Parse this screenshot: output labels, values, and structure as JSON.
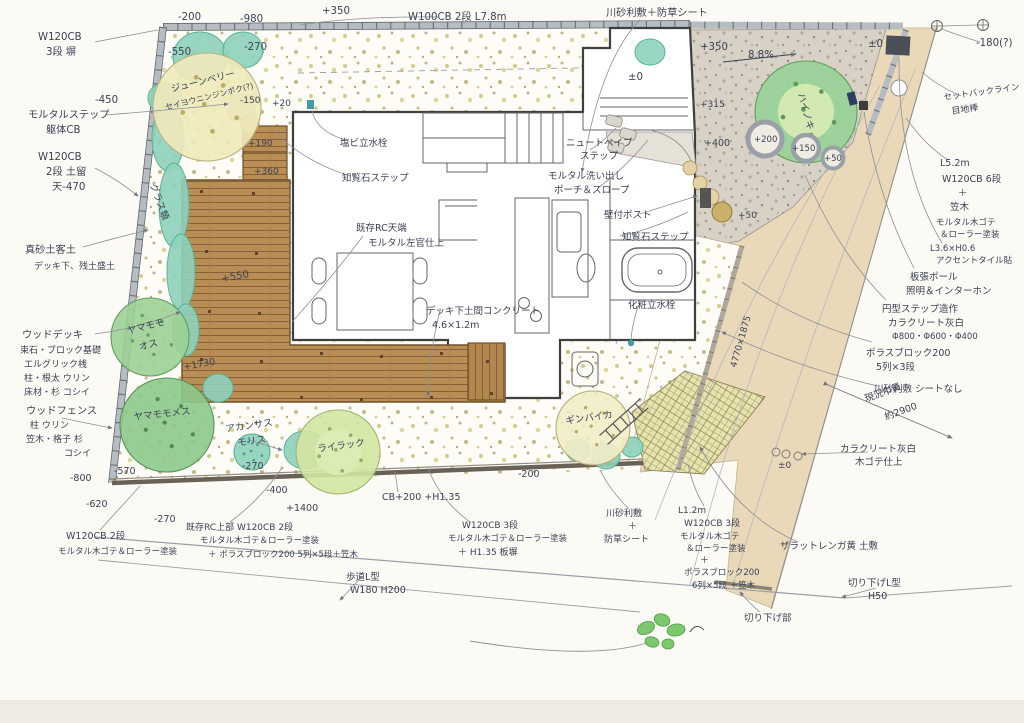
{
  "plan": {
    "ink_color": "#3c4257",
    "paper_color": "#fbfaf4",
    "deck_color": "#b98e54",
    "concrete_color": "#d8d1c5",
    "approach_color": "#ead9b9",
    "teal_plant_color": "#8ed2bc",
    "brick_area_color": "#e7e3ae"
  },
  "plants": [
    {
      "name": "june-berry",
      "label": "ジューンベリー セイヨウニンジンボク(?)",
      "cx": 207,
      "cy": 107,
      "r": 54,
      "fill": "#efe9ba",
      "stroke": "#b9b183",
      "dot": "#bcae62"
    },
    {
      "name": "yamamomo-male",
      "label": "ヤマモモ オス",
      "cx": 150,
      "cy": 337,
      "r": 39,
      "fill": "#9cd096",
      "stroke": "#5f9e5f",
      "dot": "#63a463"
    },
    {
      "name": "yamamomo-female",
      "label": "ヤマモモ メス",
      "cx": 167,
      "cy": 425,
      "r": 47,
      "fill": "#8cc98b",
      "stroke": "#569355",
      "dot": "#4f8c4f"
    },
    {
      "name": "lilac",
      "label": "ライラック",
      "cx": 338,
      "cy": 452,
      "r": 42,
      "fill": "#d3e5a3",
      "stroke": "#9ab86e",
      "dot": "#95b164"
    },
    {
      "name": "ginbaika",
      "label": "ギンバイカ",
      "cx": 593,
      "cy": 428,
      "r": 37,
      "fill": "#f2ecc7",
      "stroke": "#b8ad74",
      "dot": "#b5a963"
    },
    {
      "name": "hainoki",
      "label": "ハイノキ",
      "cx": 806,
      "cy": 112,
      "r": 51,
      "fill": "#98d198",
      "stroke": "#5f9e5f",
      "dot": "#5a9b5a"
    },
    {
      "name": "acanthus-mollis",
      "label": "アカンサスモリス",
      "cx": 252,
      "cy": 452,
      "r": 18,
      "fill": "#8ed2bc",
      "stroke": "#58b394",
      "dot": "#4da183"
    }
  ],
  "shrubs": [
    {
      "cx": 200,
      "cy": 57,
      "rx": 27,
      "ry": 25
    },
    {
      "cx": 243,
      "cy": 50,
      "rx": 20,
      "ry": 18
    },
    {
      "cx": 165,
      "cy": 98,
      "rx": 17,
      "ry": 15
    },
    {
      "cx": 168,
      "cy": 138,
      "rx": 16,
      "ry": 33
    },
    {
      "cx": 174,
      "cy": 205,
      "rx": 15,
      "ry": 42
    },
    {
      "cx": 181,
      "cy": 272,
      "rx": 14,
      "ry": 38
    },
    {
      "cx": 186,
      "cy": 330,
      "rx": 13,
      "ry": 26
    },
    {
      "cx": 218,
      "cy": 388,
      "rx": 15,
      "ry": 14
    },
    {
      "cx": 305,
      "cy": 450,
      "rx": 21,
      "ry": 19
    },
    {
      "cx": 578,
      "cy": 450,
      "rx": 12,
      "ry": 11
    },
    {
      "cx": 606,
      "cy": 456,
      "rx": 14,
      "ry": 13
    },
    {
      "cx": 632,
      "cy": 447,
      "rx": 11,
      "ry": 10
    },
    {
      "cx": 650,
      "cy": 52,
      "rx": 15,
      "ry": 13
    }
  ],
  "annotations": [
    {
      "t": "W120CB",
      "x": 38,
      "y": 40
    },
    {
      "t": "3段 塀",
      "x": 46,
      "y": 55
    },
    {
      "t": "-200",
      "x": 178,
      "y": 20
    },
    {
      "t": "-980",
      "x": 240,
      "y": 22
    },
    {
      "t": "+350",
      "x": 322,
      "y": 14
    },
    {
      "t": "W100CB 2段 L7.8m",
      "x": 408,
      "y": 20
    },
    {
      "t": "川砂利敷＋防草シート",
      "x": 606,
      "y": 16
    },
    {
      "t": "-180(?)",
      "x": 976,
      "y": 46
    },
    {
      "t": "-550",
      "x": 168,
      "y": 55
    },
    {
      "t": "-270",
      "x": 244,
      "y": 50
    },
    {
      "t": "±0",
      "x": 628,
      "y": 80
    },
    {
      "t": "±0",
      "x": 868,
      "y": 47
    },
    {
      "t": "+350",
      "x": 700,
      "y": 50
    },
    {
      "t": "8.8%",
      "x": 748,
      "y": 58
    },
    {
      "t": "-450",
      "x": 95,
      "y": 103
    },
    {
      "t": "モルタルステップ",
      "x": 28,
      "y": 118
    },
    {
      "t": "躯体CB",
      "x": 46,
      "y": 133
    },
    {
      "t": "-150",
      "x": 240,
      "y": 103,
      "s": 9
    },
    {
      "t": "+20",
      "x": 272,
      "y": 106,
      "s": 9
    },
    {
      "t": "W120CB",
      "x": 38,
      "y": 160
    },
    {
      "t": "2段 土留",
      "x": 46,
      "y": 175
    },
    {
      "t": "天-470",
      "x": 52,
      "y": 190
    },
    {
      "t": "ジューンベリー",
      "x": 172,
      "y": 92,
      "r": -14,
      "s": 9.5
    },
    {
      "t": "セイヨウニンジンボク(?)",
      "x": 166,
      "y": 110,
      "r": -14,
      "s": 8
    },
    {
      "t": "グラス類",
      "x": 150,
      "y": 185,
      "r": 70,
      "s": 9.5
    },
    {
      "t": "+190",
      "x": 248,
      "y": 146,
      "s": 9
    },
    {
      "t": "+360",
      "x": 254,
      "y": 174,
      "s": 9
    },
    {
      "t": "真砂土客土",
      "x": 25,
      "y": 253
    },
    {
      "t": "デッキ下、残土盛土",
      "x": 34,
      "y": 269,
      "s": 9
    },
    {
      "t": "塩ビ立水栓",
      "x": 340,
      "y": 146,
      "s": 9.5
    },
    {
      "t": "知覧石ステップ",
      "x": 342,
      "y": 181,
      "s": 9.5
    },
    {
      "t": "既存RC天端",
      "x": 356,
      "y": 231,
      "s": 9.5
    },
    {
      "t": "モルタル左官仕上",
      "x": 368,
      "y": 246,
      "s": 9.5
    },
    {
      "t": "+550",
      "x": 222,
      "y": 282,
      "r": -10
    },
    {
      "t": "+1730",
      "x": 184,
      "y": 370,
      "r": -10,
      "s": 9.5
    },
    {
      "t": "ヤマモモ",
      "x": 128,
      "y": 334,
      "r": -14,
      "s": 9.5
    },
    {
      "t": "オス",
      "x": 140,
      "y": 350,
      "r": -14,
      "s": 9.5
    },
    {
      "t": "ヤマモモメス",
      "x": 134,
      "y": 420,
      "r": -6,
      "s": 9.5
    },
    {
      "t": "ウッドデッキ",
      "x": 22,
      "y": 338
    },
    {
      "t": "束石・ブロック基礎",
      "x": 20,
      "y": 353,
      "s": 9
    },
    {
      "t": "エルグリック桟",
      "x": 24,
      "y": 367,
      "s": 9
    },
    {
      "t": "柱・根太 ウリン",
      "x": 24,
      "y": 381,
      "s": 9
    },
    {
      "t": "床材・杉 コシイ",
      "x": 24,
      "y": 395,
      "s": 9
    },
    {
      "t": "ウッドフェンス",
      "x": 26,
      "y": 414
    },
    {
      "t": "柱 ウリン",
      "x": 30,
      "y": 428,
      "s": 9
    },
    {
      "t": "笠木・格子 杉",
      "x": 26,
      "y": 442,
      "s": 9
    },
    {
      "t": "コシイ",
      "x": 64,
      "y": 456,
      "s": 9
    },
    {
      "t": "アカンサス",
      "x": 226,
      "y": 432,
      "r": -8,
      "s": 9.5
    },
    {
      "t": "モリス",
      "x": 238,
      "y": 446,
      "r": -8,
      "s": 9.5
    },
    {
      "t": "ライラック",
      "x": 318,
      "y": 452,
      "r": -8,
      "s": 9.5
    },
    {
      "t": "ギンバイカ",
      "x": 566,
      "y": 424,
      "r": -8,
      "s": 9.5
    },
    {
      "t": "ハイノキ",
      "x": 798,
      "y": 94,
      "r": 75,
      "s": 9.5
    },
    {
      "t": "+50",
      "x": 738,
      "y": 218,
      "s": 9
    },
    {
      "t": "+315",
      "x": 700,
      "y": 107,
      "s": 9
    },
    {
      "t": "+400",
      "x": 704,
      "y": 146,
      "s": 9.5
    },
    {
      "t": "+200",
      "x": 754,
      "y": 142,
      "s": 8.5
    },
    {
      "t": "+150",
      "x": 792,
      "y": 151,
      "s": 8.5
    },
    {
      "t": "+50",
      "x": 824,
      "y": 161,
      "s": 8.5
    },
    {
      "t": "±0",
      "x": 778,
      "y": 468,
      "s": 9
    },
    {
      "t": "4770×1875",
      "x": 736,
      "y": 368,
      "r": -74,
      "s": 9
    },
    {
      "t": "ニュートペイブ",
      "x": 566,
      "y": 146,
      "s": 9.5
    },
    {
      "t": "ステップ",
      "x": 580,
      "y": 159,
      "s": 9.5
    },
    {
      "t": "モルタル洗い出し",
      "x": 548,
      "y": 179,
      "s": 9.5
    },
    {
      "t": "ポーチ＆スロープ",
      "x": 554,
      "y": 193,
      "s": 9.5
    },
    {
      "t": "壁付ポスト",
      "x": 604,
      "y": 218,
      "s": 9.5
    },
    {
      "t": "知覧石ステップ",
      "x": 622,
      "y": 240,
      "s": 9.5
    },
    {
      "t": "化粧立水栓",
      "x": 628,
      "y": 308,
      "s": 9.5
    },
    {
      "t": "デッキ下土間コンクリート",
      "x": 426,
      "y": 314,
      "s": 9.5
    },
    {
      "t": "4.6×1.2m",
      "x": 432,
      "y": 328,
      "s": 9.5
    },
    {
      "t": "-800",
      "x": 70,
      "y": 481,
      "s": 9.5
    },
    {
      "t": "-620",
      "x": 86,
      "y": 507,
      "s": 9.5
    },
    {
      "t": "-570",
      "x": 114,
      "y": 474,
      "s": 9.5
    },
    {
      "t": "-270",
      "x": 242,
      "y": 469,
      "s": 9.5
    },
    {
      "t": "-270",
      "x": 154,
      "y": 522,
      "s": 9.5
    },
    {
      "t": "-400",
      "x": 266,
      "y": 493,
      "s": 9.5
    },
    {
      "t": "+1400",
      "x": 286,
      "y": 511,
      "s": 9.5
    },
    {
      "t": "-200",
      "x": 518,
      "y": 477,
      "s": 9.5
    },
    {
      "t": "W120CB 2段",
      "x": 66,
      "y": 539,
      "s": 9.5
    },
    {
      "t": "モルタル木ゴテ＆ローラー塗装",
      "x": 58,
      "y": 554,
      "s": 8.5
    },
    {
      "t": "既存RC上部 W120CB 2段",
      "x": 186,
      "y": 530,
      "s": 9
    },
    {
      "t": "モルタル木ゴテ＆ローラー塗装",
      "x": 200,
      "y": 543,
      "s": 8.5
    },
    {
      "t": "＋ ポラスブロック200 5列×5段＋笠木",
      "x": 208,
      "y": 557,
      "s": 8.5
    },
    {
      "t": "CB+200 +H1.35",
      "x": 382,
      "y": 500,
      "s": 9.5
    },
    {
      "t": "W120CB 3段",
      "x": 462,
      "y": 528,
      "s": 9
    },
    {
      "t": "モルタル木ゴテ＆ローラー塗装",
      "x": 448,
      "y": 541,
      "s": 8.5
    },
    {
      "t": "＋ H1.35 板塀",
      "x": 458,
      "y": 555,
      "s": 9
    },
    {
      "t": "川砂利敷",
      "x": 606,
      "y": 516,
      "s": 9
    },
    {
      "t": "＋",
      "x": 628,
      "y": 529,
      "s": 9
    },
    {
      "t": "防草シート",
      "x": 604,
      "y": 542,
      "s": 9
    },
    {
      "t": "L1.2m",
      "x": 678,
      "y": 513,
      "s": 9
    },
    {
      "t": "W120CB 3段",
      "x": 684,
      "y": 526,
      "s": 9
    },
    {
      "t": "モルタル木ゴテ",
      "x": 680,
      "y": 539,
      "s": 8.5
    },
    {
      "t": "＆ローラー塗装",
      "x": 686,
      "y": 551,
      "s": 8.5
    },
    {
      "t": "＋",
      "x": 700,
      "y": 563,
      "s": 9
    },
    {
      "t": "ポラスブロック200",
      "x": 684,
      "y": 575,
      "s": 8.5
    },
    {
      "t": "6列×5段 ＋笠木",
      "x": 692,
      "y": 588,
      "s": 8.5
    },
    {
      "t": "ザラットレンガ黄 土敷",
      "x": 780,
      "y": 549,
      "s": 9.5
    },
    {
      "t": "切り下げL型",
      "x": 848,
      "y": 586,
      "s": 9.5
    },
    {
      "t": "H50",
      "x": 868,
      "y": 599,
      "s": 9.5
    },
    {
      "t": "切り下げ部",
      "x": 744,
      "y": 621,
      "s": 9.5
    },
    {
      "t": "歩道L型",
      "x": 346,
      "y": 580,
      "s": 9.5
    },
    {
      "t": "W180 H200",
      "x": 350,
      "y": 593,
      "s": 9.5
    },
    {
      "t": "現況巾員",
      "x": 866,
      "y": 402,
      "r": -20,
      "s": 9.5
    },
    {
      "t": "約2900",
      "x": 886,
      "y": 420,
      "r": -20,
      "s": 9.5
    },
    {
      "t": "セットバックライン",
      "x": 944,
      "y": 100,
      "r": -8,
      "s": 8.5
    },
    {
      "t": "目地棒",
      "x": 952,
      "y": 114,
      "r": -8,
      "s": 9
    },
    {
      "t": "L5.2m",
      "x": 940,
      "y": 166,
      "s": 9.5
    },
    {
      "t": "W120CB 6段",
      "x": 942,
      "y": 182,
      "s": 9.5
    },
    {
      "t": "＋",
      "x": 958,
      "y": 196,
      "s": 9.5
    },
    {
      "t": "笠木",
      "x": 950,
      "y": 210,
      "s": 9.5
    },
    {
      "t": "モルタル木ゴテ",
      "x": 936,
      "y": 225,
      "s": 8.5
    },
    {
      "t": "＆ローラー塗装",
      "x": 940,
      "y": 237,
      "s": 8.5
    },
    {
      "t": "L3.6×H0.6",
      "x": 930,
      "y": 251,
      "s": 8.5
    },
    {
      "t": "アクセントタイル貼",
      "x": 936,
      "y": 263,
      "s": 8.5
    },
    {
      "t": "板張ポール",
      "x": 910,
      "y": 280,
      "s": 9.5
    },
    {
      "t": "照明＆インターホン",
      "x": 906,
      "y": 294,
      "s": 9.5
    },
    {
      "t": "円型ステップ造作",
      "x": 882,
      "y": 312,
      "s": 9.5
    },
    {
      "t": "カラクリート灰白",
      "x": 888,
      "y": 326,
      "s": 9.5
    },
    {
      "t": "Φ800・Φ600・Φ400",
      "x": 892,
      "y": 339,
      "s": 8.5
    },
    {
      "t": "ポラスブロック200",
      "x": 866,
      "y": 356,
      "s": 9.5
    },
    {
      "t": "5列×3段",
      "x": 876,
      "y": 370,
      "s": 9.5
    },
    {
      "t": "川砂利敷 シートなし",
      "x": 874,
      "y": 392,
      "s": 9.5
    },
    {
      "t": "カラクリート灰白",
      "x": 840,
      "y": 452,
      "s": 9.5
    },
    {
      "t": "木ゴテ仕上",
      "x": 855,
      "y": 465,
      "s": 9.5
    }
  ]
}
